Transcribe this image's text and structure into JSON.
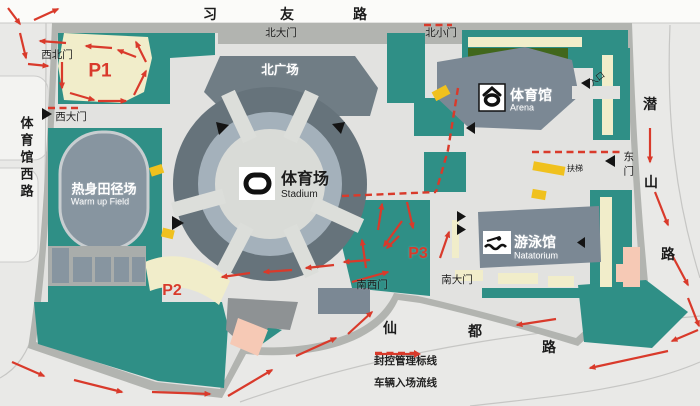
{
  "title": "体育中心交通流线图",
  "colors": {
    "red": "#d93a2b",
    "black": "#1c1c1c",
    "white": "#ffffff",
    "road": "#e9e9e7",
    "top_road": "#fbfbf9",
    "sidewalk": "#b2b4b0",
    "inner_road": "#e2e2e0",
    "green": "#2f8f86",
    "hedge": "#41671c",
    "cream": "#f1edca",
    "yellow": "#f0c11e",
    "pink": "#f6c9b5",
    "building": "#7b8894",
    "plaza": "#707d85",
    "ring_outer": "#66737b",
    "ring_mid": "#a4b1bb",
    "ring_inner": "#d9dbd7",
    "field": "#8795a0"
  },
  "roads": {
    "top": "习友路",
    "left": "体育馆西路",
    "right": "潜山路",
    "bottom": "仙都路"
  },
  "venues": {
    "stadium": {
      "zh": "体育场",
      "en": "Stadium"
    },
    "arena": {
      "zh": "体育馆",
      "en": "Arena"
    },
    "natatorium": {
      "zh": "游泳馆",
      "en": "Natatorium"
    },
    "warmup_field": {
      "zh": "热身田径场",
      "en": "Warm up Field"
    },
    "north_plaza": {
      "zh": "北广场"
    }
  },
  "gates": [
    "北大门",
    "北小门",
    "西北门",
    "西大门",
    "东门",
    "南西门",
    "南大门"
  ],
  "parking_zones": [
    "P1",
    "P2",
    "P3"
  ],
  "poi": {
    "entrance": "入口",
    "escalator": "扶梯"
  },
  "legend": {
    "dashed": "封控管理标线",
    "arrow": "车辆入场流线"
  },
  "labels": [
    {
      "n": "road-xiyou-char-1",
      "t": "习",
      "x": 210,
      "y": 14,
      "s": 14,
      "b": 1
    },
    {
      "n": "road-xiyou-char-2",
      "t": "友",
      "x": 287,
      "y": 14,
      "s": 14,
      "b": 1
    },
    {
      "n": "road-xiyou-char-3",
      "t": "路",
      "x": 360,
      "y": 14,
      "s": 14,
      "b": 1
    },
    {
      "n": "road-tiyuguanxi",
      "t": "体育馆西路",
      "x": 26,
      "y": 116,
      "s": 13,
      "b": 1,
      "v": 1
    },
    {
      "n": "road-qianshan-char-1",
      "t": "潜",
      "x": 650,
      "y": 104,
      "s": 14,
      "b": 1
    },
    {
      "n": "road-qianshan-char-2",
      "t": "山",
      "x": 651,
      "y": 182,
      "s": 14,
      "b": 1
    },
    {
      "n": "road-qianshan-char-3",
      "t": "路",
      "x": 668,
      "y": 254,
      "s": 14,
      "b": 1
    },
    {
      "n": "road-xiandu-char-1",
      "t": "仙",
      "x": 390,
      "y": 328,
      "s": 14,
      "b": 1
    },
    {
      "n": "road-xiandu-char-2",
      "t": "都",
      "x": 475,
      "y": 331,
      "s": 14,
      "b": 1
    },
    {
      "n": "road-xiandu-char-3",
      "t": "路",
      "x": 549,
      "y": 347,
      "s": 14,
      "b": 1
    },
    {
      "n": "gate-beidamen",
      "t": "北大门",
      "x": 281,
      "y": 33,
      "s": 10.5
    },
    {
      "n": "gate-beixiaomen",
      "t": "北小门",
      "x": 441,
      "y": 33,
      "s": 10.5
    },
    {
      "n": "gate-xibeimen",
      "t": "西北门",
      "x": 57,
      "y": 55,
      "s": 10.5
    },
    {
      "n": "gate-xidamen",
      "t": "西大门",
      "x": 71,
      "y": 117,
      "s": 10.5
    },
    {
      "n": "gate-nanximen",
      "t": "南西门",
      "x": 372,
      "y": 285,
      "s": 10.5
    },
    {
      "n": "gate-nandamen",
      "t": "南大门",
      "x": 457,
      "y": 280,
      "s": 10.5
    },
    {
      "n": "gate-dongmen",
      "t": "东门",
      "x": 628,
      "y": 151,
      "s": 10.5,
      "v": 1
    },
    {
      "n": "entrance-label",
      "t": "入口",
      "x": 597,
      "y": 79,
      "s": 8.5,
      "r": -38
    },
    {
      "n": "escalator-label",
      "t": "扶梯",
      "x": 575,
      "y": 169,
      "s": 8
    },
    {
      "n": "north-plaza-label",
      "t": "北广场",
      "x": 280,
      "y": 70,
      "s": 12.5,
      "c": "white",
      "b": 1
    },
    {
      "n": "stadium-label-zh",
      "t": "体育场",
      "x": 281,
      "y": 180,
      "s": 16,
      "b": 1,
      "a": "start"
    },
    {
      "n": "stadium-label-en",
      "t": "Stadium",
      "x": 281,
      "y": 195,
      "s": 10,
      "a": "start"
    },
    {
      "n": "arena-label-zh",
      "t": "体育馆",
      "x": 510,
      "y": 95,
      "s": 14,
      "b": 1,
      "c": "white",
      "a": "start"
    },
    {
      "n": "arena-label-en",
      "t": "Arena",
      "x": 510,
      "y": 108,
      "s": 9,
      "c": "white",
      "a": "start"
    },
    {
      "n": "natatorium-label-zh",
      "t": "游泳馆",
      "x": 514,
      "y": 242,
      "s": 14,
      "b": 1,
      "c": "white",
      "a": "start"
    },
    {
      "n": "natatorium-label-en",
      "t": "Natatorium",
      "x": 514,
      "y": 256,
      "s": 9,
      "c": "white",
      "a": "start"
    },
    {
      "n": "warmup-field-label-zh",
      "t": "热身田径场",
      "x": 104,
      "y": 189,
      "s": 13,
      "b": 1,
      "c": "white"
    },
    {
      "n": "warmup-field-label-en",
      "t": "Warm up Field",
      "x": 100,
      "y": 202,
      "s": 9,
      "c": "white"
    },
    {
      "n": "parking-p1-label",
      "t": "P1",
      "x": 100,
      "y": 71,
      "s": 19,
      "b": 1,
      "c": "red"
    },
    {
      "n": "parking-p2-label",
      "t": "P2",
      "x": 172,
      "y": 291,
      "s": 16,
      "b": 1,
      "c": "red"
    },
    {
      "n": "parking-p3-label",
      "t": "P3",
      "x": 418,
      "y": 254,
      "s": 16,
      "b": 1,
      "c": "red"
    }
  ],
  "flow_arrows": [
    [
      8,
      8,
      20,
      24
    ],
    [
      34,
      20,
      58,
      9
    ],
    [
      20,
      33,
      26,
      58
    ],
    [
      28,
      64,
      48,
      66
    ],
    [
      66,
      43,
      40,
      41
    ],
    [
      112,
      48,
      86,
      46
    ],
    [
      136,
      57,
      118,
      50
    ],
    [
      62,
      62,
      62,
      88
    ],
    [
      70,
      93,
      94,
      100
    ],
    [
      98,
      101,
      126,
      101
    ],
    [
      134,
      95,
      146,
      71
    ],
    [
      146,
      62,
      136,
      42
    ],
    [
      250,
      273,
      222,
      277
    ],
    [
      292,
      270,
      264,
      272
    ],
    [
      334,
      265,
      306,
      268
    ],
    [
      370,
      260,
      344,
      262
    ],
    [
      402,
      221,
      384,
      246
    ],
    [
      352,
      282,
      388,
      272
    ],
    [
      366,
      268,
      362,
      240
    ],
    [
      378,
      230,
      382,
      204
    ],
    [
      407,
      202,
      413,
      228
    ],
    [
      399,
      236,
      387,
      248
    ],
    [
      440,
      258,
      449,
      232
    ],
    [
      12,
      362,
      44,
      376
    ],
    [
      74,
      380,
      122,
      392
    ],
    [
      152,
      392,
      210,
      394
    ],
    [
      228,
      396,
      272,
      370
    ],
    [
      296,
      356,
      336,
      338
    ],
    [
      348,
      334,
      372,
      312
    ],
    [
      556,
      319,
      517,
      325
    ],
    [
      668,
      351,
      590,
      368
    ],
    [
      698,
      330,
      672,
      341
    ],
    [
      650,
      128,
      650,
      162
    ],
    [
      655,
      192,
      668,
      225
    ],
    [
      672,
      255,
      688,
      285
    ],
    [
      688,
      298,
      699,
      326
    ]
  ],
  "control_dashes": [
    [
      [
        48,
        108
      ],
      [
        78,
        108
      ]
    ],
    [
      [
        424,
        25
      ],
      [
        452,
        25
      ]
    ],
    [
      [
        458,
        88
      ],
      [
        448,
        150
      ],
      [
        436,
        192
      ]
    ],
    [
      [
        342,
        196
      ],
      [
        436,
        192
      ]
    ],
    [
      [
        532,
        152
      ],
      [
        624,
        152
      ]
    ]
  ]
}
